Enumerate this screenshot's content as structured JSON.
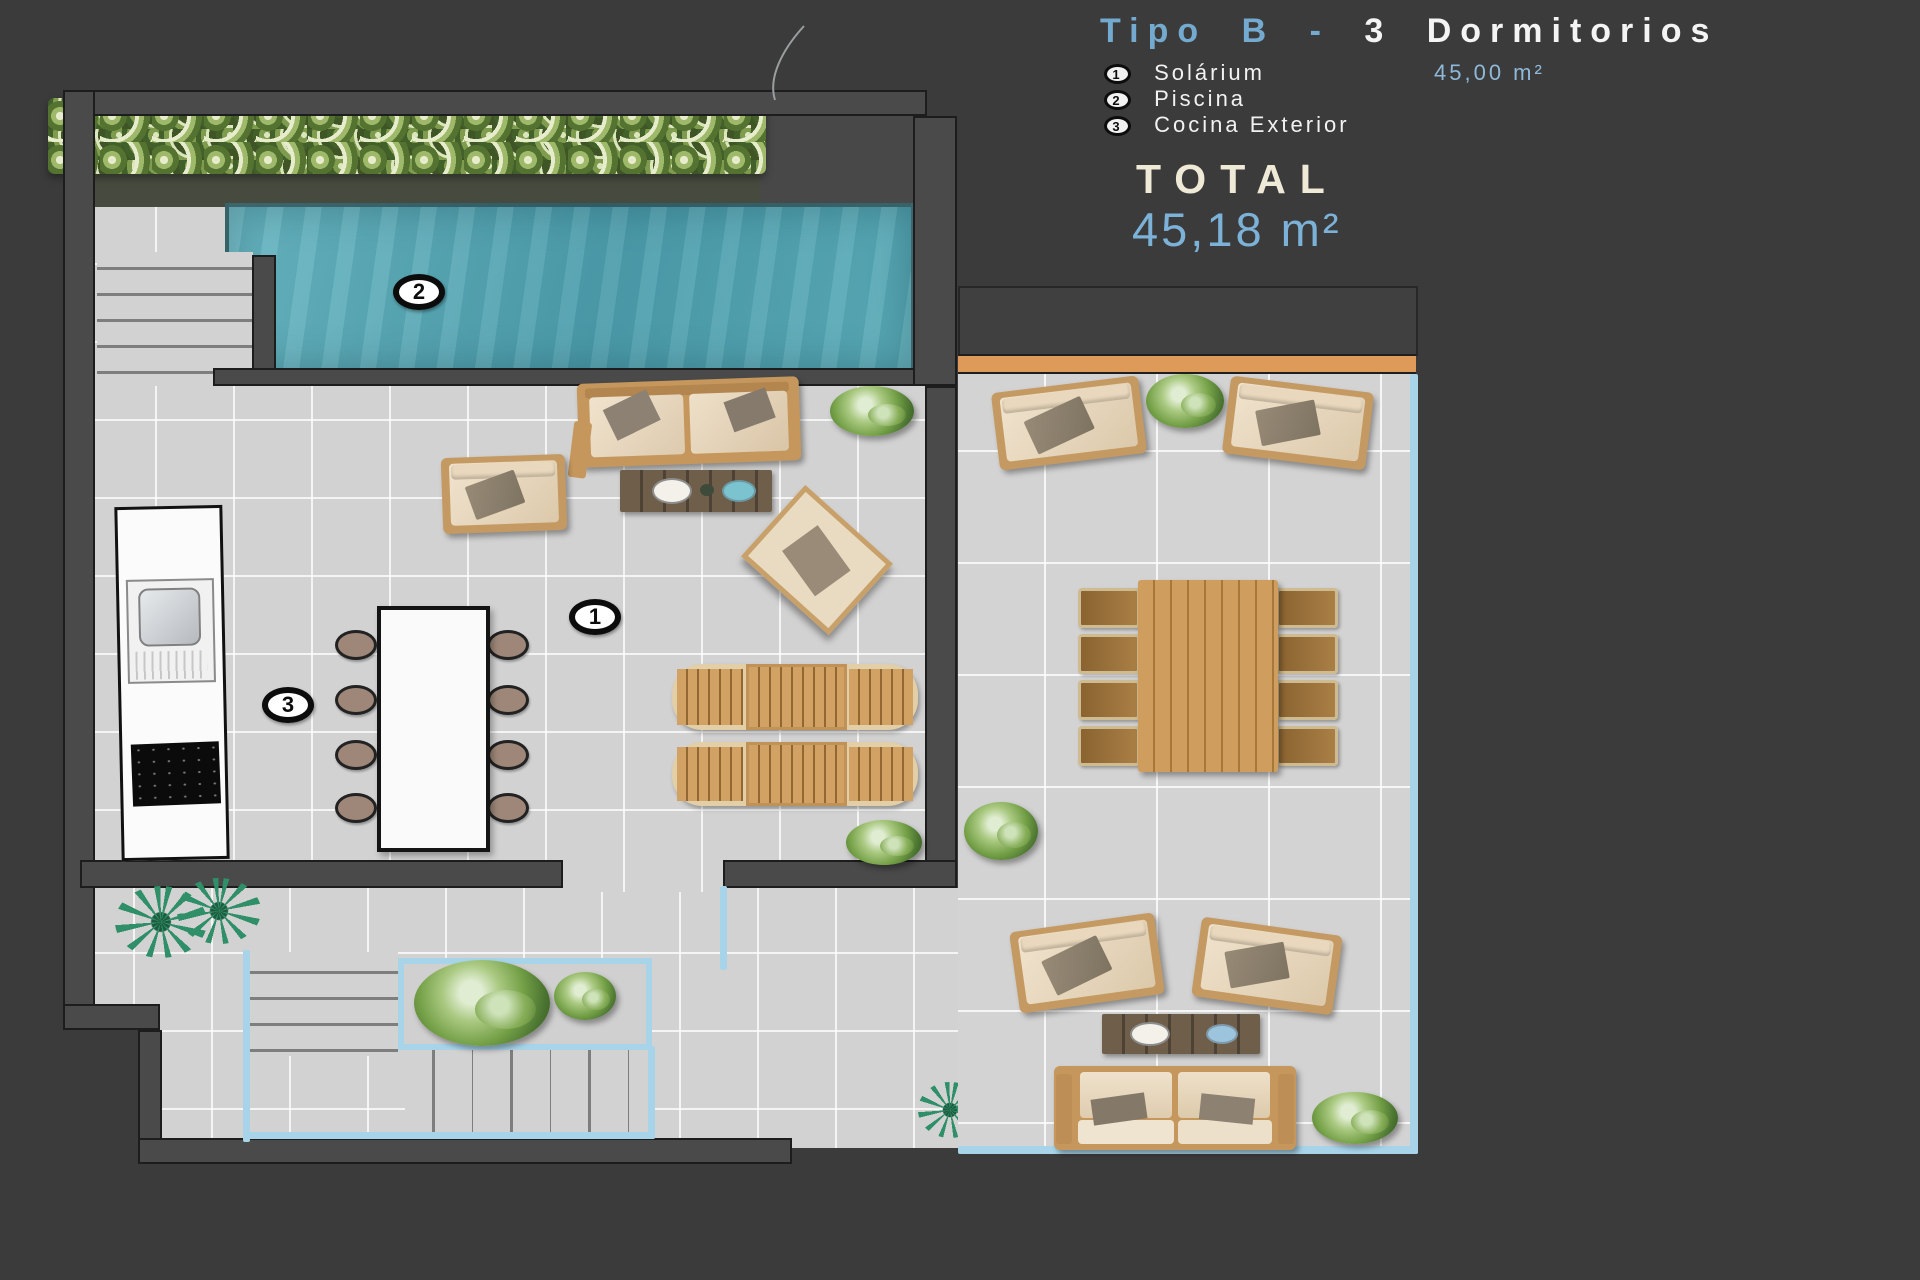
{
  "header": {
    "title_blue": "Tipo B -",
    "title_white": "3 Dormitorios",
    "legend": [
      {
        "num": "1",
        "label": "Solárium",
        "value": "45,00 m²"
      },
      {
        "num": "2",
        "label": "Piscina",
        "value": ""
      },
      {
        "num": "3",
        "label": "Cocina Exterior",
        "value": ""
      }
    ],
    "total_label": "TOTAL",
    "total_value": "45,18 m²"
  },
  "plan": {
    "badge_solarium": "1",
    "badge_piscina": "2",
    "badge_cocina": "3"
  },
  "colors": {
    "background": "#3b3b3b",
    "accent_blue": "#74aacf",
    "cream": "#efe8d5",
    "pool_teal": "#58aab7",
    "deck_orange": "#dd9a58",
    "stair_outline_blue": "#a8d4ea",
    "tile_gray": "#d2d2d2"
  }
}
